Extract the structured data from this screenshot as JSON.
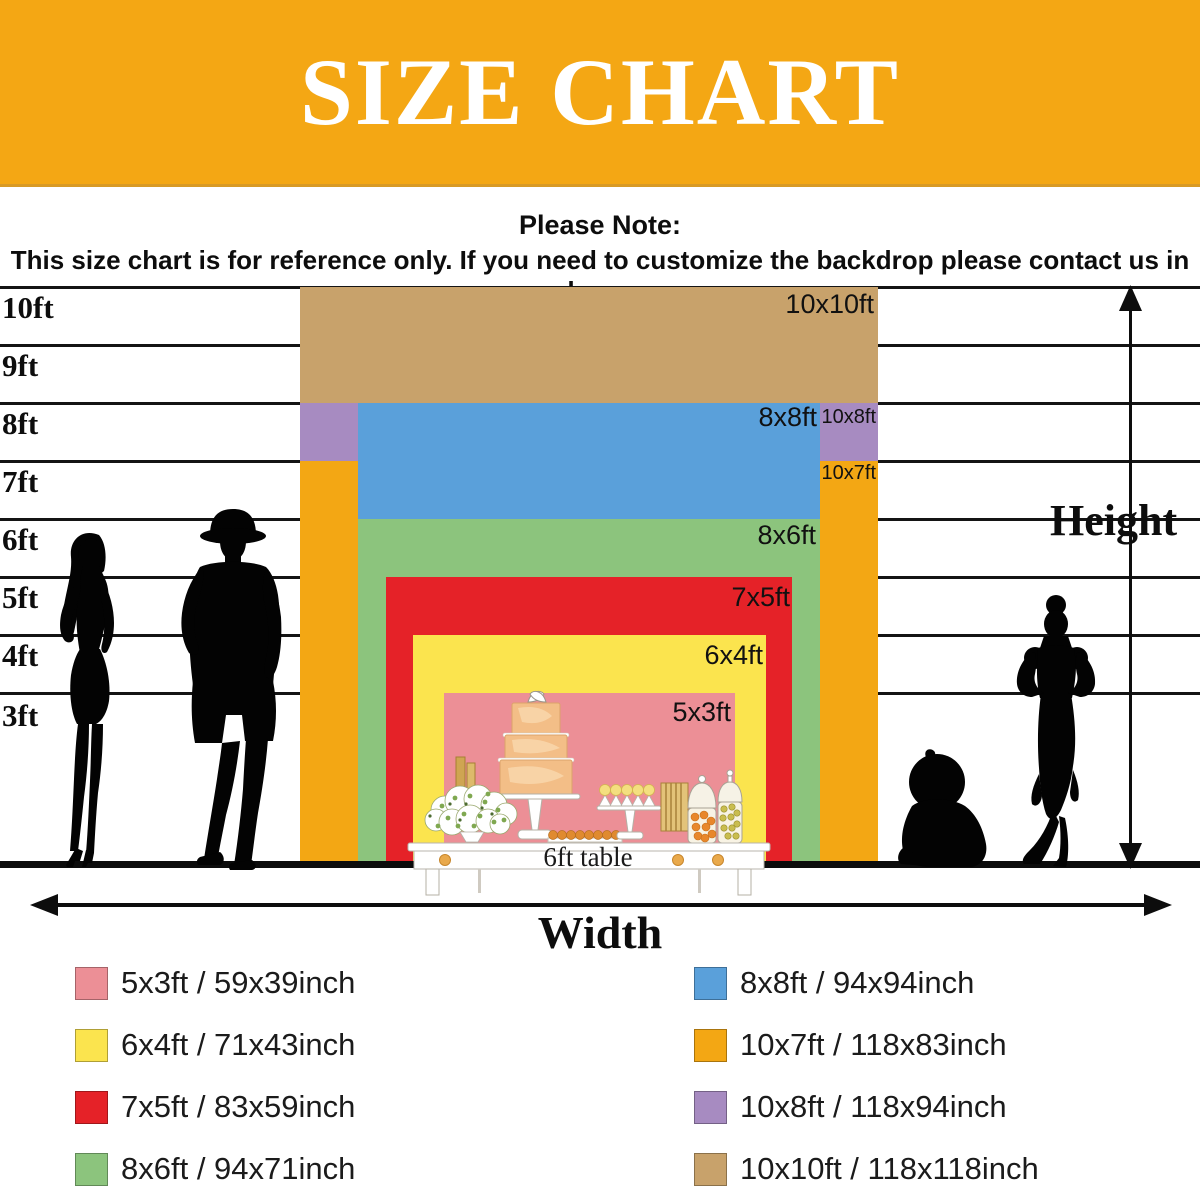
{
  "header": {
    "title": "SIZE CHART",
    "background": "#F4A714"
  },
  "note": {
    "heading": "Please Note:",
    "body": "This size chart is for reference only. If you need to customize the backdrop please contact us in advance."
  },
  "axis": {
    "ticks": [
      "10ft",
      "9ft",
      "8ft",
      "7ft",
      "6ft",
      "5ft",
      "4ft",
      "3ft"
    ],
    "height_label": "Height",
    "width_label": "Width"
  },
  "table_label": "6ft table",
  "sizes": [
    {
      "id": "10x10ft",
      "chart_label": "10x10ft",
      "color": "#C8A26B"
    },
    {
      "id": "10x8ft",
      "chart_label": "10x8ft",
      "color": "#A78BC1"
    },
    {
      "id": "10x7ft",
      "chart_label": "10x7ft",
      "color": "#F3A714"
    },
    {
      "id": "8x8ft",
      "chart_label": "8x8ft",
      "color": "#5AA0DA"
    },
    {
      "id": "8x6ft",
      "chart_label": "8x6ft",
      "color": "#8CC47D"
    },
    {
      "id": "7x5ft",
      "chart_label": "7x5ft",
      "color": "#E52228"
    },
    {
      "id": "6x4ft",
      "chart_label": "6x4ft",
      "color": "#FBE44E"
    },
    {
      "id": "5x3ft",
      "chart_label": "5x3ft",
      "color": "#EC8F96"
    }
  ],
  "legend": {
    "left": [
      {
        "label": "5x3ft / 59x39inch",
        "color": "#EC8F96"
      },
      {
        "label": "6x4ft / 71x43inch",
        "color": "#FBE44E"
      },
      {
        "label": "7x5ft / 83x59inch",
        "color": "#E52228"
      },
      {
        "label": "8x6ft / 94x71inch",
        "color": "#8CC47D"
      }
    ],
    "right": [
      {
        "label": "8x8ft / 94x94inch",
        "color": "#5AA0DA"
      },
      {
        "label": "10x7ft / 118x83inch",
        "color": "#F3A714"
      },
      {
        "label": "10x8ft / 118x94inch",
        "color": "#A78BC1"
      },
      {
        "label": "10x10ft / 118x118inch",
        "color": "#C8A26B"
      }
    ]
  },
  "chart_data": {
    "type": "table",
    "title": "SIZE CHART",
    "xlabel": "Width",
    "ylabel": "Height",
    "y_ticks_ft": [
      10,
      9,
      8,
      7,
      6,
      5,
      4,
      3
    ],
    "rows": [
      {
        "size": "5x3ft",
        "inches": "59x39inch",
        "width_ft": 5,
        "height_ft": 3,
        "width_in": 59,
        "height_in": 39,
        "color": "#EC8F96"
      },
      {
        "size": "6x4ft",
        "inches": "71x43inch",
        "width_ft": 6,
        "height_ft": 4,
        "width_in": 71,
        "height_in": 43,
        "color": "#FBE44E"
      },
      {
        "size": "7x5ft",
        "inches": "83x59inch",
        "width_ft": 7,
        "height_ft": 5,
        "width_in": 83,
        "height_in": 59,
        "color": "#E52228"
      },
      {
        "size": "8x6ft",
        "inches": "94x71inch",
        "width_ft": 8,
        "height_ft": 6,
        "width_in": 94,
        "height_in": 71,
        "color": "#8CC47D"
      },
      {
        "size": "8x8ft",
        "inches": "94x94inch",
        "width_ft": 8,
        "height_ft": 8,
        "width_in": 94,
        "height_in": 94,
        "color": "#5AA0DA"
      },
      {
        "size": "10x7ft",
        "inches": "118x83inch",
        "width_ft": 10,
        "height_ft": 7,
        "width_in": 118,
        "height_in": 83,
        "color": "#F3A714"
      },
      {
        "size": "10x8ft",
        "inches": "118x94inch",
        "width_ft": 10,
        "height_ft": 8,
        "width_in": 118,
        "height_in": 94,
        "color": "#A78BC1"
      },
      {
        "size": "10x10ft",
        "inches": "118x118inch",
        "width_ft": 10,
        "height_ft": 10,
        "width_in": 118,
        "height_in": 118,
        "color": "#C8A26B"
      }
    ],
    "reference_object": "6ft table"
  }
}
